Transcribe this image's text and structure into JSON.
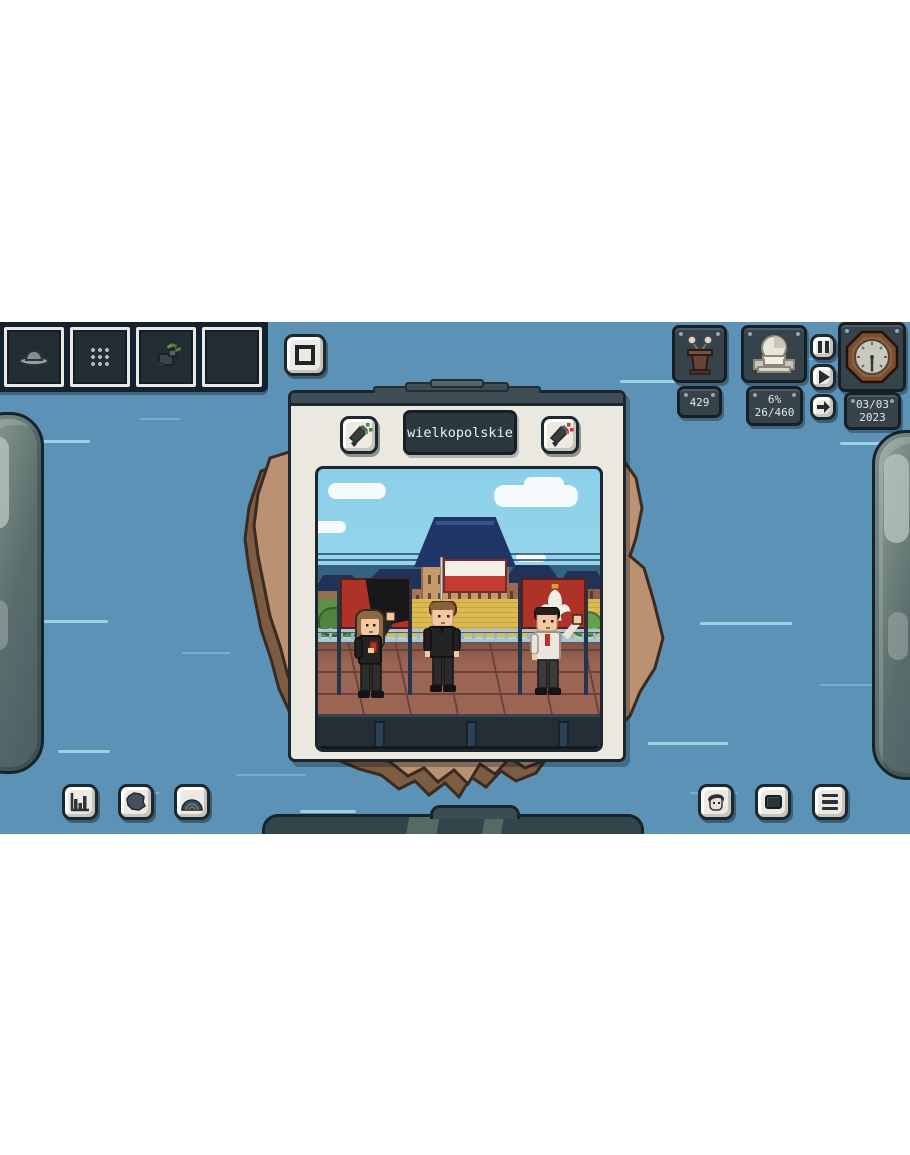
{
  "region_panel": {
    "title": "wielkopolskie",
    "left_campaign_button": {
      "icon": "megaphone-icon",
      "effect": "positive-green"
    },
    "right_campaign_button": {
      "icon": "megaphone-icon",
      "effect": "negative-red"
    }
  },
  "hud": {
    "podium": {
      "icon": "podium-icon",
      "value": "429"
    },
    "parliament": {
      "icon": "sejm-dome-icon",
      "percent": "6%",
      "seats": "26/460"
    },
    "speed_controls": {
      "pause": "pause",
      "play": "play",
      "skip": "skip"
    },
    "calendar": {
      "icon": "clock-icon",
      "date": "03/03",
      "year": "2023"
    }
  },
  "toolbar": {
    "slots": [
      {
        "icon": "hat-icon"
      },
      {
        "icon": "grid-icon"
      },
      {
        "icon": "plant-icon"
      },
      {
        "icon": "empty"
      }
    ]
  },
  "bottom_left_buttons": [
    "stats",
    "poland-map",
    "parliament-hemicycle"
  ],
  "bottom_right_buttons": [
    "character",
    "tv",
    "menu"
  ],
  "scene": {
    "location": "rally stage in front of village houses",
    "flags": [
      "red-black banner",
      "polish flag",
      "red banner with white eagle"
    ],
    "characters": [
      "long-haired activist in black",
      "man in black suit",
      "man in white shirt waving"
    ]
  },
  "colors": {
    "water_blue": "#5d92b7",
    "panel_cream": "#ebe8e0",
    "slate_dark": "#37434b",
    "map_tan": "#bb9173",
    "flag_red": "#c33b31",
    "banner_red": "#ad3329",
    "spark_green": "#3f8a46",
    "spark_red": "#c03a2e"
  }
}
